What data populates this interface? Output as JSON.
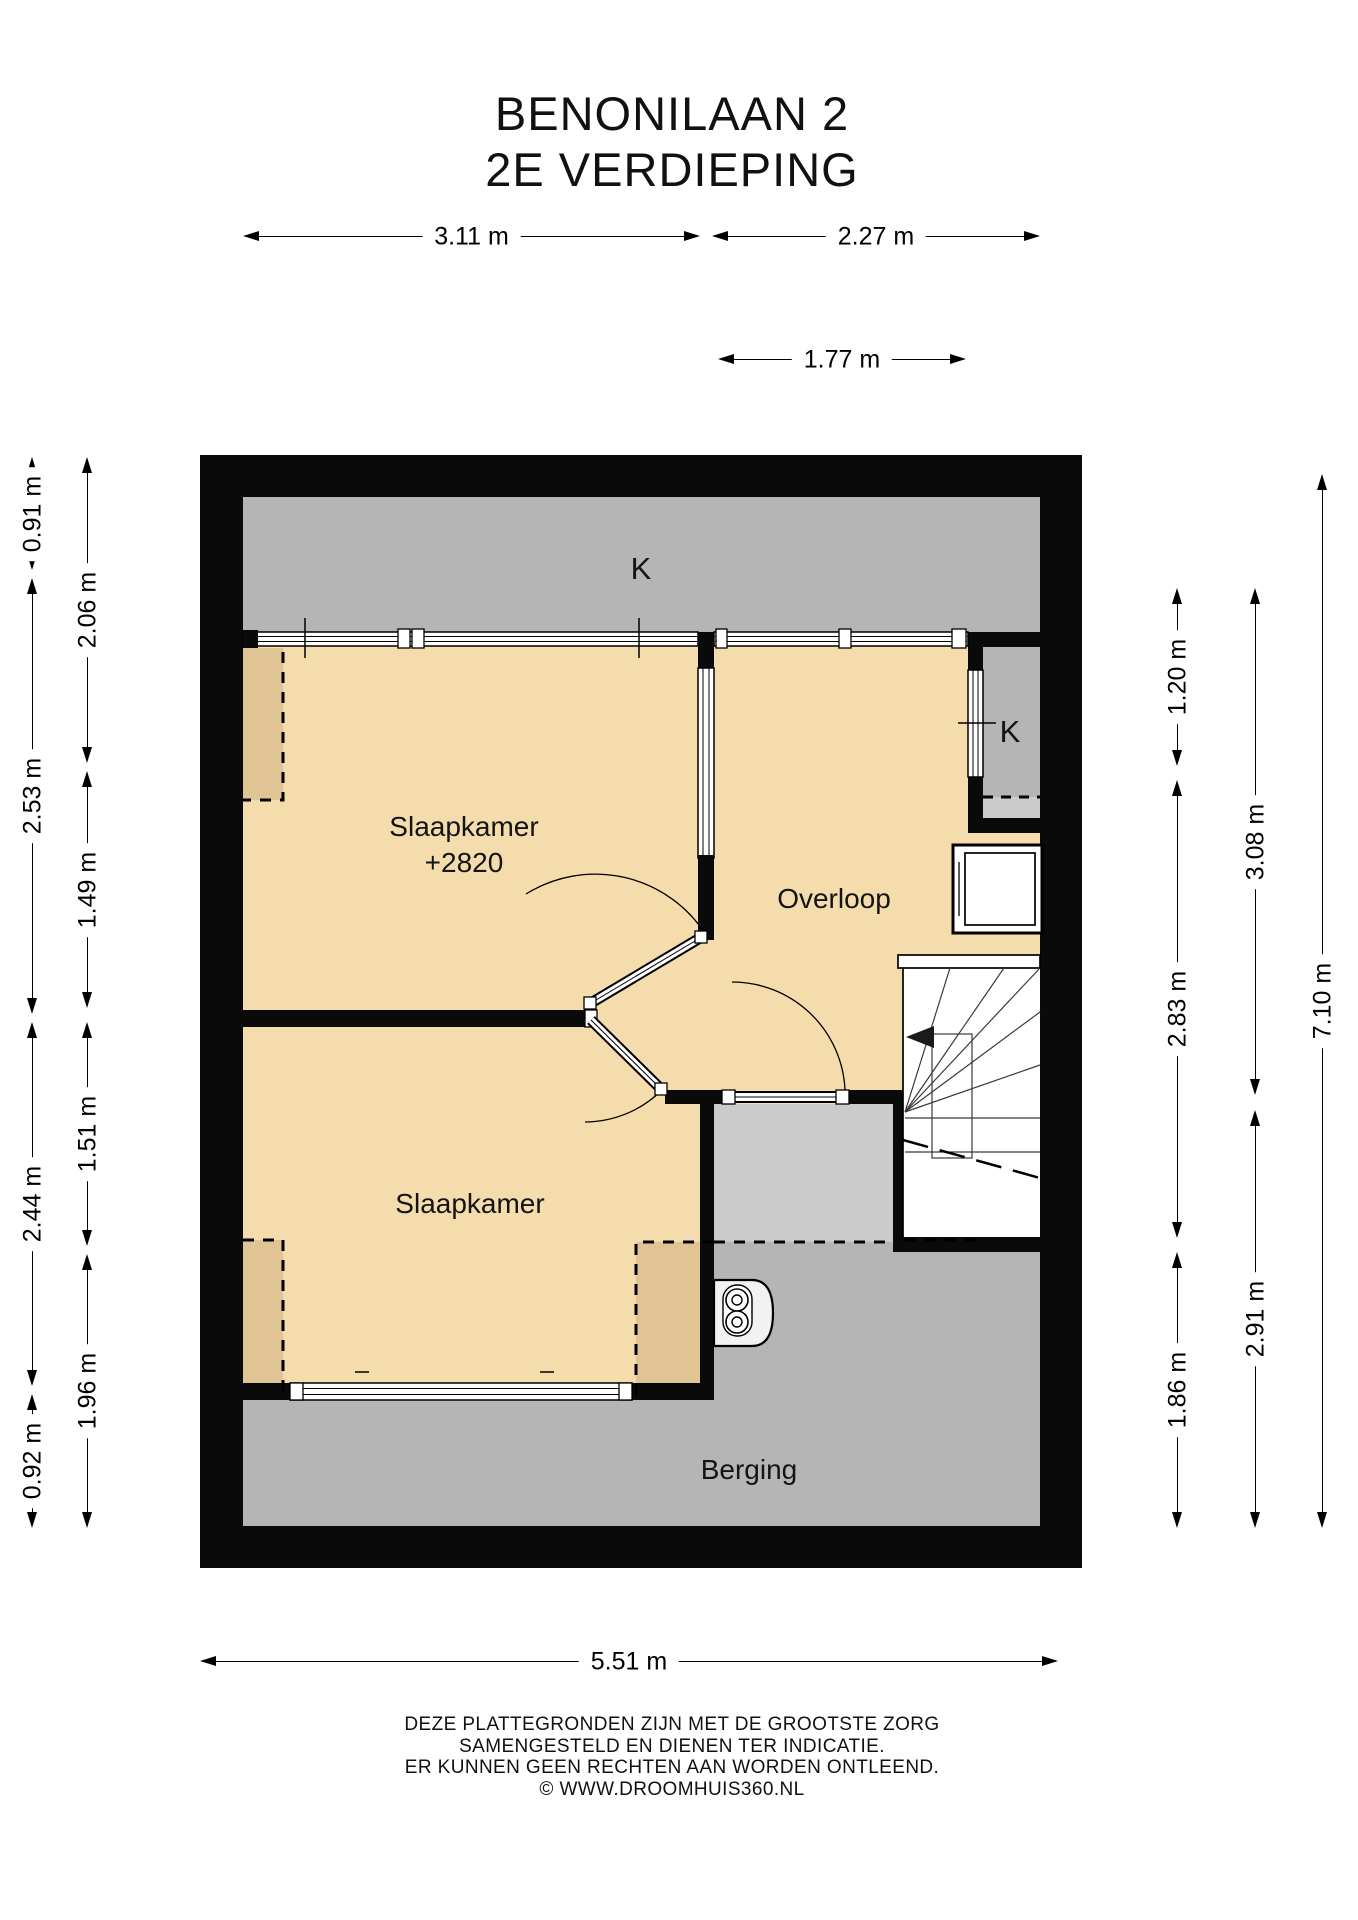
{
  "title": {
    "line1": "BENONILAAN 2",
    "line2": "2E VERDIEPING"
  },
  "rooms": {
    "bedroom1": {
      "name": "Slaapkamer",
      "area": "+2820"
    },
    "bedroom2": {
      "name": "Slaapkamer"
    },
    "landing": {
      "name": "Overloop"
    },
    "storage": {
      "name": "Berging"
    },
    "closet_top": {
      "name": "K"
    },
    "closet_right": {
      "name": "K"
    }
  },
  "dimensions": {
    "top_row1_left": "3.11 m",
    "top_row1_right": "2.27 m",
    "top_row2": "1.77 m",
    "bottom": "5.51 m",
    "left_outer": [
      "0.91 m",
      "2.53 m",
      "2.44 m",
      "0.92 m"
    ],
    "left_inner": [
      "2.06 m",
      "1.49 m",
      "1.51 m",
      "1.96 m"
    ],
    "right_inner": [
      "1.20 m",
      "2.83 m",
      "1.86 m"
    ],
    "right_middle": [
      "3.08 m",
      "2.91 m"
    ],
    "right_outer": "7.10 m"
  },
  "footer": {
    "line1": "DEZE PLATTEGRONDEN ZIJN MET DE GROOTSTE ZORG",
    "line2": "SAMENGESTELD EN DIENEN TER INDICATIE.",
    "line3": "ER KUNNEN GEEN RECHTEN AAN WORDEN ONTLEEND.",
    "line4": "© WWW.DROOMHUIS360.NL"
  },
  "colors": {
    "wall": "#0a0a0a",
    "room": "#f5dcad",
    "room_shaded": "#e0c494",
    "gray": "#b5b5b5",
    "gray_light": "#cbcbcb"
  }
}
